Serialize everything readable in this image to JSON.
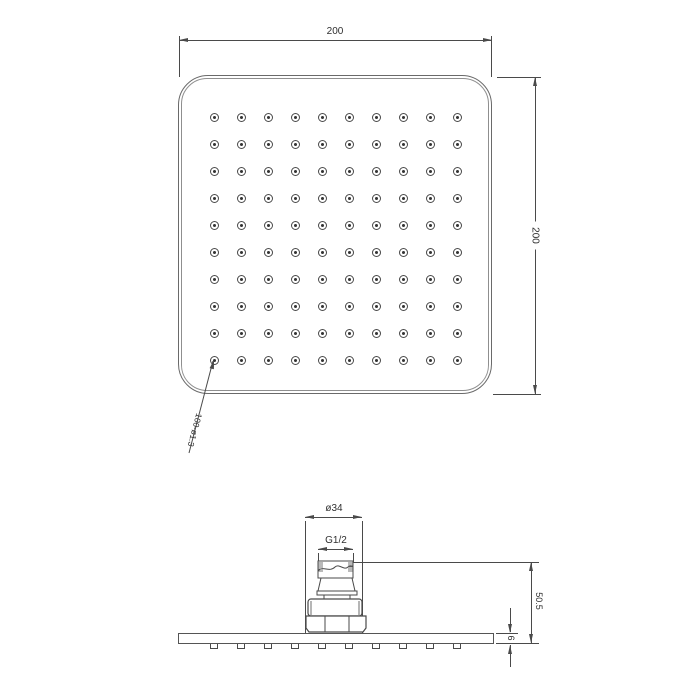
{
  "drawing_type": "technical dimension drawing — square rain shower head, top view and side view",
  "colors": {
    "background": "#ffffff",
    "line": "#4a4a4a",
    "body_edge": "#6a6a6a",
    "text": "#2f2f2f"
  },
  "top_view": {
    "width_dim": {
      "label": "200"
    },
    "height_dim": {
      "label": "200"
    },
    "nozzle_note": {
      "label": "100-ø1.3"
    },
    "grid": {
      "rows": 10,
      "cols": 10
    }
  },
  "side_view": {
    "connector_diameter_dim": {
      "label": "ø34"
    },
    "thread_dim": {
      "label": "G1/2"
    },
    "overall_height_dim": {
      "label": "50.5"
    },
    "plate_thickness_dim": {
      "label": "6"
    }
  }
}
